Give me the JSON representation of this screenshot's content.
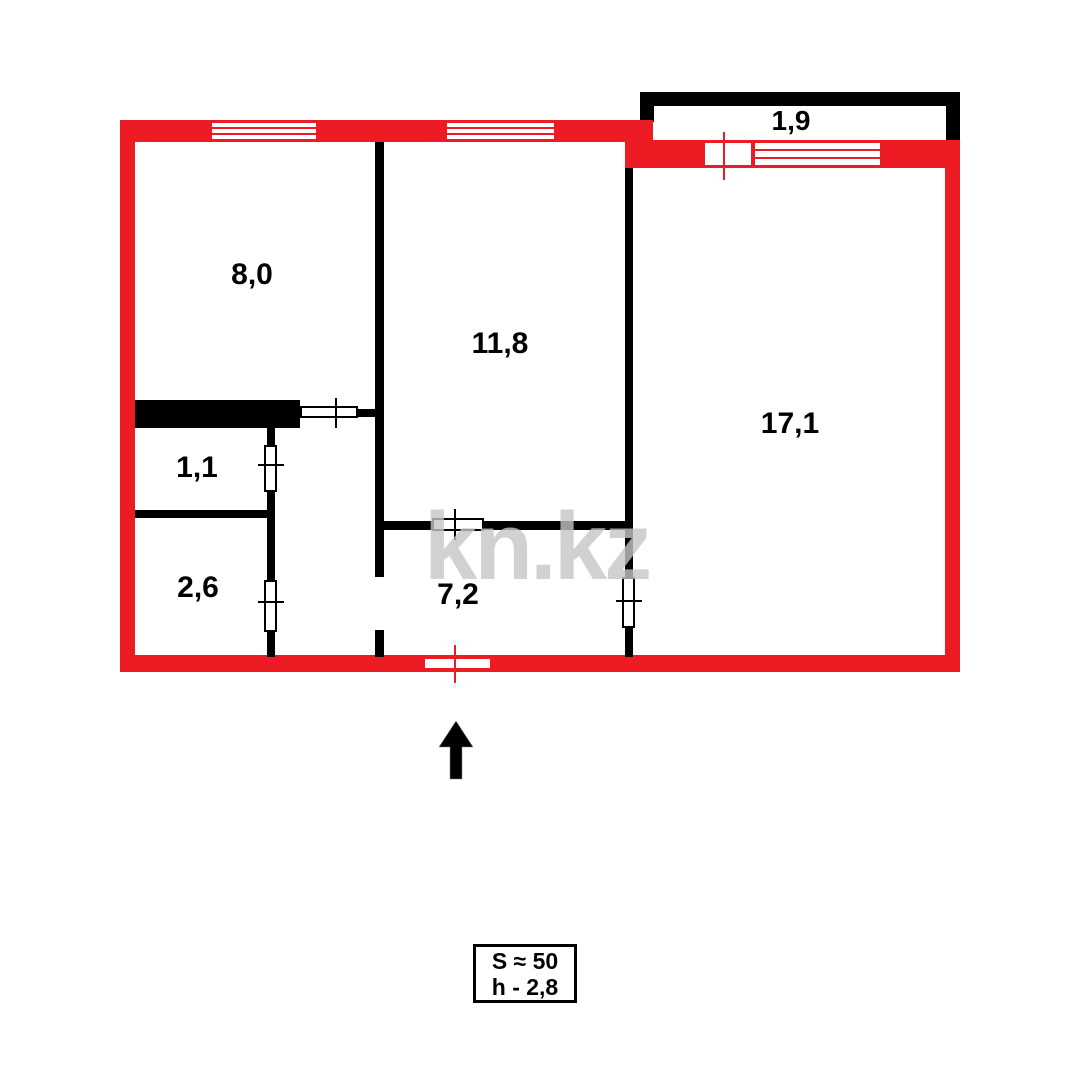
{
  "floor_plan": {
    "watermark_text": "kn.kz",
    "rooms": [
      {
        "id": "room-8-0",
        "area_label": "8,0"
      },
      {
        "id": "room-11-8",
        "area_label": "11,8"
      },
      {
        "id": "room-17-1",
        "area_label": "17,1"
      },
      {
        "id": "room-1-1",
        "area_label": "1,1"
      },
      {
        "id": "room-2-6",
        "area_label": "2,6"
      },
      {
        "id": "room-7-2",
        "area_label": "7,2"
      },
      {
        "id": "balcony",
        "area_label": "1,9"
      }
    ],
    "info_box": {
      "area_line": "S ≈ 50",
      "height_line": "h - 2,8"
    },
    "colors": {
      "outer_wall_red": "#ed1c24",
      "inner_wall_black": "#000000",
      "background": "#ffffff",
      "watermark_gray": "#c6c6c6"
    }
  }
}
